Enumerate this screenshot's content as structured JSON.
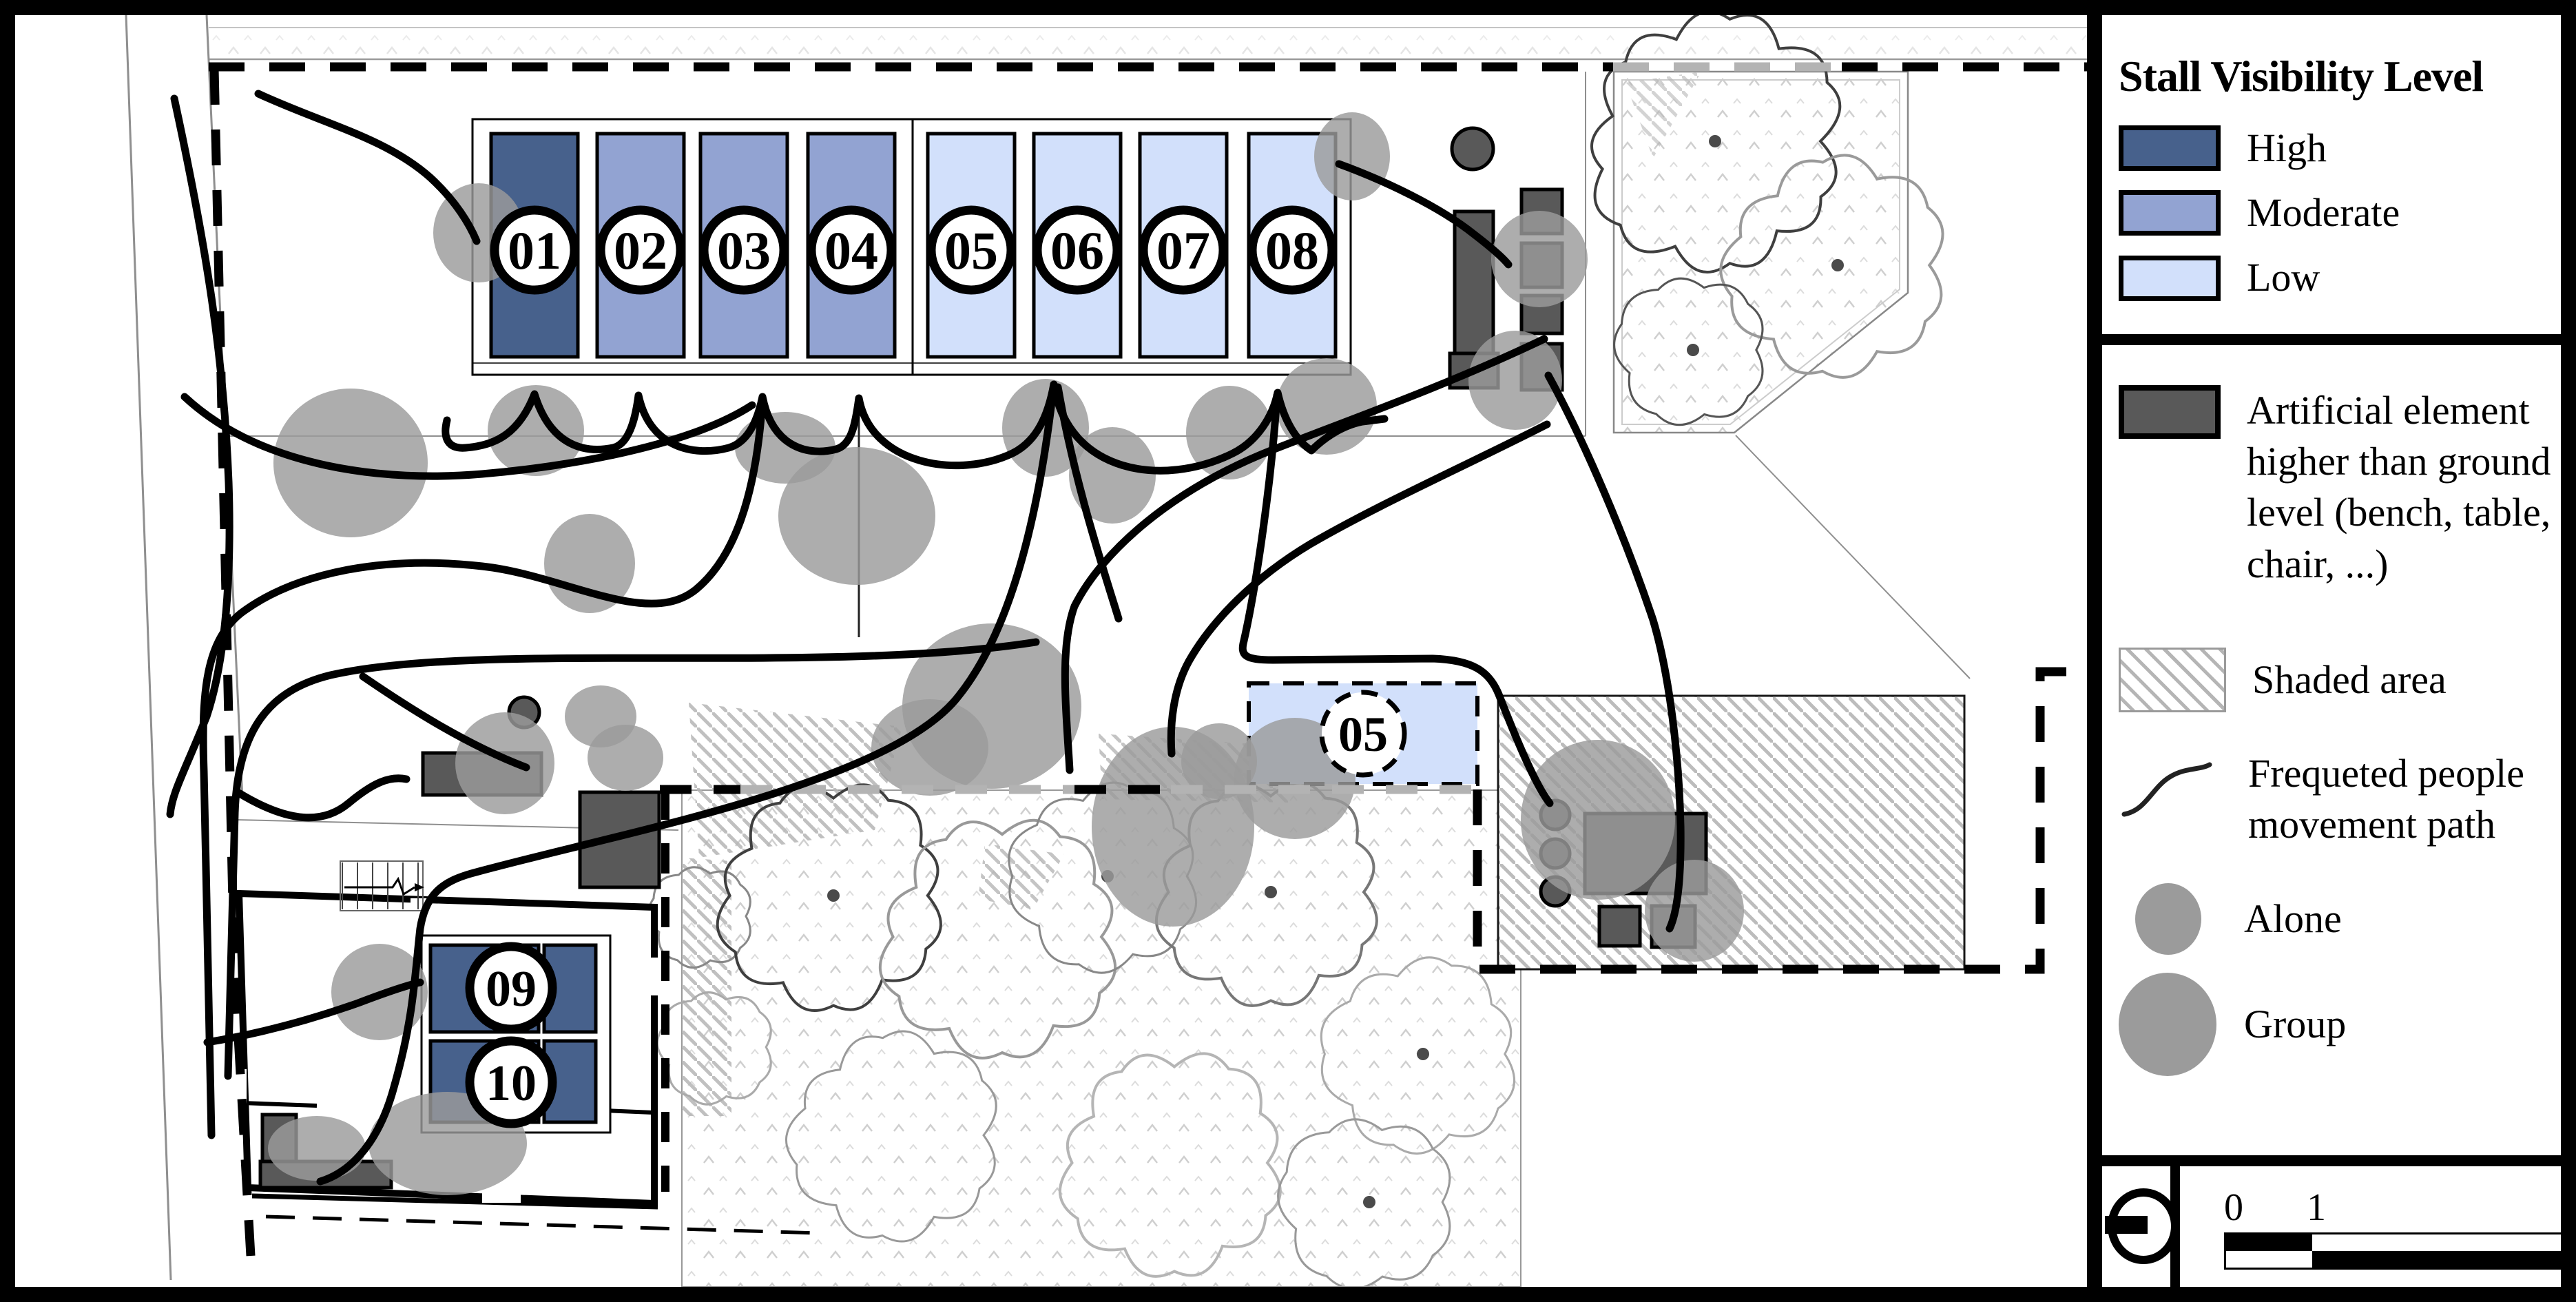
{
  "palette": {
    "high": "#47618c",
    "moderate": "#92a3d2",
    "low": "#d2e0fb",
    "indoor_stall": "#47618c",
    "furniture": "#595959",
    "people": "#9b9b9b",
    "movement_path": "#000000",
    "hatch": "#b5b5b5",
    "boundary_black": "#000000",
    "boundary_gray": "#b3b3b3"
  },
  "legend": {
    "title": "Stall Visibility Level",
    "visibility_items": [
      {
        "label": "High",
        "key": "high"
      },
      {
        "label": "Moderate",
        "key": "moderate"
      },
      {
        "label": "Low",
        "key": "low"
      }
    ],
    "artificial_label": "Artificial element higher than ground level (bench, table, chair, ...)",
    "shaded_label": "Shaded area",
    "path_label": "Frequeted people movement path",
    "alone_label": "Alone",
    "group_label": "Group"
  },
  "scale_bar": {
    "tick0": "0",
    "tick1": "1",
    "tick2": "4m"
  },
  "plan": {
    "stall_row": [
      {
        "label": "01",
        "level": "high"
      },
      {
        "label": "02",
        "level": "moderate"
      },
      {
        "label": "03",
        "level": "moderate"
      },
      {
        "label": "04",
        "level": "moderate"
      },
      {
        "label": "05",
        "level": "low"
      },
      {
        "label": "06",
        "level": "low"
      },
      {
        "label": "07",
        "level": "low"
      },
      {
        "label": "08",
        "level": "low"
      }
    ],
    "relocated_stall": {
      "label": "05",
      "level": "low"
    },
    "indoor_stalls": [
      {
        "label": "09",
        "level": "high"
      },
      {
        "label": "10",
        "level": "high"
      }
    ],
    "people": [
      [
        695,
        338,
        66,
        72
      ],
      [
        509,
        672,
        112,
        108
      ],
      [
        778,
        625,
        70,
        66
      ],
      [
        856,
        818,
        66,
        72
      ],
      [
        872,
        1040,
        52,
        45
      ],
      [
        733,
        1108,
        72,
        74
      ],
      [
        1140,
        650,
        73,
        52
      ],
      [
        1244,
        749,
        114,
        100
      ],
      [
        1518,
        621,
        63,
        71
      ],
      [
        1615,
        690,
        63,
        70
      ],
      [
        1785,
        628,
        63,
        68
      ],
      [
        1926,
        590,
        73,
        70
      ],
      [
        1963,
        227,
        55,
        64
      ],
      [
        2235,
        376,
        70,
        70
      ],
      [
        2200,
        552,
        68,
        72
      ],
      [
        2320,
        1190,
        112,
        116
      ],
      [
        2460,
        1322,
        72,
        74
      ],
      [
        1770,
        1105,
        55,
        55
      ],
      [
        1440,
        1025,
        130,
        120
      ],
      [
        551,
        1440,
        70,
        70
      ],
      [
        650,
        1660,
        115,
        75
      ],
      [
        460,
        1667,
        71,
        47
      ],
      [
        908,
        1100,
        55,
        48
      ],
      [
        1350,
        1085,
        85,
        70
      ],
      [
        1703,
        1200,
        118,
        145
      ],
      [
        1880,
        1130,
        88,
        88
      ]
    ],
    "trees": [
      [
        2490,
        205,
        170,
        "#3f3f3f",
        1
      ],
      [
        2668,
        385,
        148,
        "#9a9a9a",
        1
      ],
      [
        2458,
        508,
        102,
        "#555555",
        1
      ],
      [
        1020,
        1330,
        70,
        "#888888",
        0
      ],
      [
        1042,
        1520,
        78,
        "#aaaaaa",
        0
      ],
      [
        1210,
        1300,
        152,
        "#3f3f3f",
        1
      ],
      [
        1455,
        1360,
        160,
        "#999999",
        0
      ],
      [
        1608,
        1272,
        128,
        "#888888",
        1
      ],
      [
        1845,
        1295,
        150,
        "#777777",
        1
      ],
      [
        2066,
        1530,
        132,
        "#aaaaaa",
        1
      ],
      [
        1302,
        1648,
        140,
        "#999999",
        0
      ],
      [
        1705,
        1688,
        150,
        "#b5b5b5",
        0
      ],
      [
        1988,
        1745,
        118,
        "#999999",
        1
      ]
    ],
    "movement_paths": [
      "M649,610 C642,638 652,652 676,650 C714,647 752,634 776,572 C800,650 852,658 890,650 C912,645 922,612 927,574 C944,652 1010,663 1058,650 C1086,642 1100,610 1107,576 C1122,652 1176,662 1214,652 C1236,646 1242,616 1247,578 C1264,674 1390,696 1470,658 C1506,640 1522,602 1530,558 C1550,688 1690,708 1790,658 C1826,640 1848,604 1855,570 C1864,610 1882,640 1904,654 C1922,636 1948,618 1978,612 L2010,608",
      "M253,143 C300,360 325,520 332,700 C336,820 330,950 300,1040 C268,1120 250,1150 247,1182",
      "M1107,580 C1098,720 1066,810 1010,856 C940,912 820,835 700,822 C560,806 430,830 350,890 C300,930 292,1000 296,1120 C300,1300 304,1500 307,1648",
      "M268,576 C380,680 560,700 700,688 C820,678 1000,648 1092,588",
      "M1504,932 C1200,980 700,930 480,980 C390,1002 345,1060 341,1180 C338,1330 334,1480 331,1562",
      "M1530,558 C1514,700 1480,900 1392,1010 C1294,1138 902,1208 684,1268 C642,1280 618,1298 610,1348 C602,1420 600,1480 572,1578 C552,1652 514,1700 465,1715",
      "M1536,562 C1560,700 1600,820 1624,898",
      "M1854,574 C1846,700 1824,850 1806,930 C1800,952 1808,958 1848,958 L2080,956 C2138,958 2162,974 2176,1008 C2198,1064 2228,1138 2250,1166",
      "M2242,492 C2100,560 1952,612 1850,652 C1702,710 1600,800 1560,880 C1538,940 1548,1030 1553,1118",
      "M2246,616 C2120,680 2002,732 1902,790 C1822,838 1760,900 1726,960 C1704,1000 1698,1050 1701,1094",
      "M1944,238 C2010,262 2090,300 2140,340 C2166,360 2182,374 2190,384",
      "M2248,545 C2300,640 2360,780 2400,900 C2424,980 2438,1100 2440,1200 C2441,1272 2436,1322 2424,1348",
      "M345,1150 C420,1196 470,1196 506,1166 C542,1136 566,1126 590,1131",
      "M527,982 C600,1032 680,1082 764,1114",
      "M301,1513 C380,1500 452,1480 520,1456 C562,1440 592,1430 610,1426",
      "M375,136 C470,180 560,200 625,258 C662,292 682,326 692,350"
    ],
    "furniture_rects": [
      [
        2112,
        307,
        56,
        256
      ],
      [
        2209,
        275,
        59,
        64
      ],
      [
        2209,
        353,
        59,
        64
      ],
      [
        2209,
        429,
        59,
        55
      ],
      [
        2209,
        499,
        59,
        67
      ],
      [
        2105,
        513,
        70,
        50
      ],
      [
        614,
        1093,
        172,
        61
      ],
      [
        842,
        1150,
        115,
        138
      ],
      [
        381,
        1618,
        49,
        71
      ],
      [
        378,
        1686,
        190,
        38
      ],
      [
        2301,
        1181,
        176,
        116
      ],
      [
        2322,
        1316,
        59,
        57
      ],
      [
        2398,
        1315,
        63,
        60
      ]
    ],
    "furniture_circles": [
      [
        2138,
        216,
        30
      ],
      [
        761,
        1034,
        22
      ],
      [
        2258,
        1183,
        21
      ],
      [
        2258,
        1239,
        21
      ],
      [
        2258,
        1294,
        21
      ]
    ]
  }
}
